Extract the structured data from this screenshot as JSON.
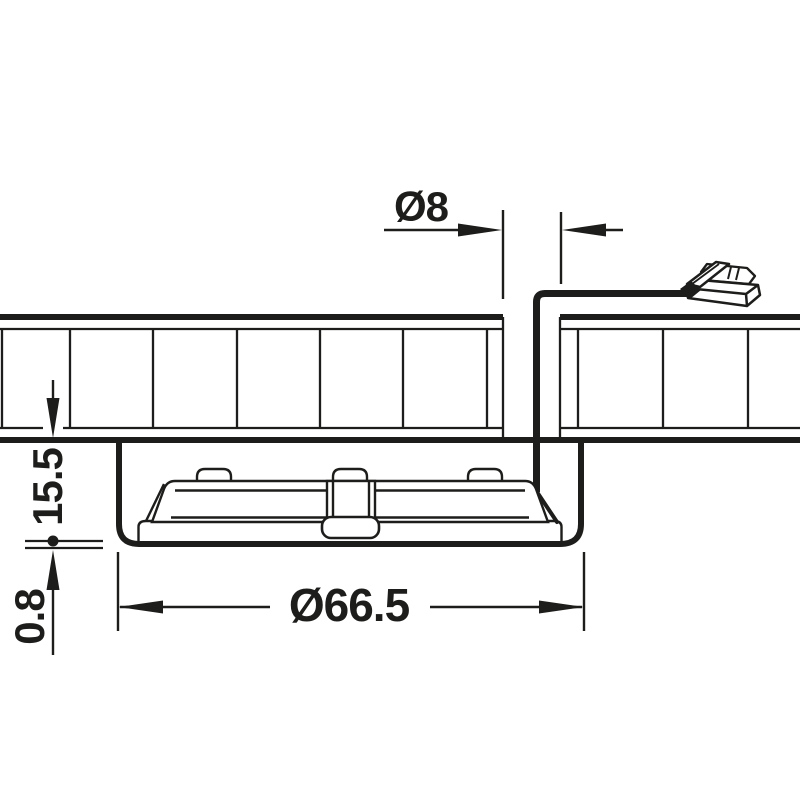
{
  "diagram": {
    "title": "recessed-light-installation-cross-section",
    "dimensions": {
      "cable_hole_diameter": {
        "label": "Ø8"
      },
      "recess_depth": {
        "label": "15.5"
      },
      "rim_thickness": {
        "label": "0.8"
      },
      "housing_diameter": {
        "label": "Ø66.5"
      }
    },
    "colors": {
      "line": "#1d1d1b",
      "background": "#ffffff"
    }
  }
}
